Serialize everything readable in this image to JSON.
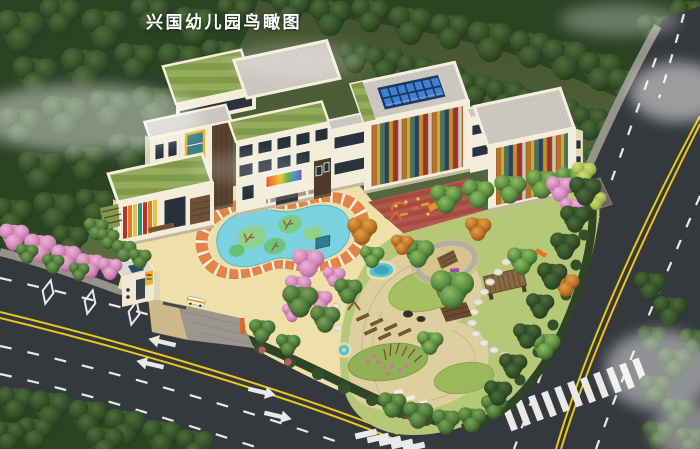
{
  "title": {
    "text": "兴国幼儿园鸟瞰图"
  },
  "palette": {
    "forest_green": "#2a4323",
    "field_green": "#52663c",
    "building_wall_cream": "#f2ecd8",
    "roof_gravel_gray": "#cbc8c1",
    "roof_grass_green": "#7e9a4a",
    "solar_panel_blue": "#3f80d2",
    "louver_red": "#b5332a",
    "louver_orange": "#e07b24",
    "louver_yellow": "#e6c23a",
    "louver_teal": "#2f8b8b",
    "pool_water_blue": "#7cd2de",
    "pool_track_orange": "#e28449",
    "courtyard_cream": "#eee0a8",
    "playground_lawn": "#b6c878",
    "sand_path_tan": "#ddd09e",
    "red_paving": "#a84a40",
    "road_asphalt": "#35383c",
    "lane_marking_yellow": "#e8c81e",
    "lane_marking_white": "#e9e9e7",
    "blossom_pink": "#dc93c3"
  }
}
